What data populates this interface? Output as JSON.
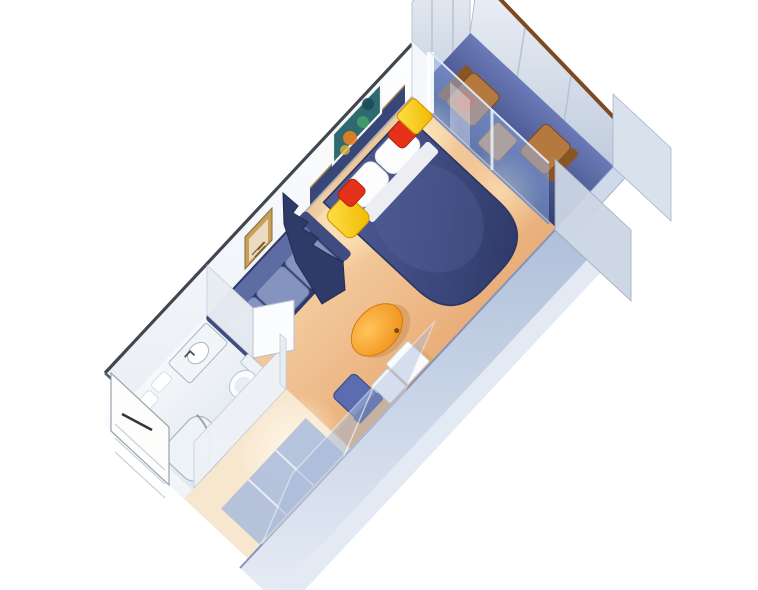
{
  "scene": {
    "name": "balcony-stateroom-isometric-floorplan",
    "rooms": [
      "entry",
      "bathroom",
      "wardrobe",
      "living-area",
      "sleeping-area",
      "balcony"
    ],
    "furniture": [
      "queen-bed",
      "pillow-left",
      "pillow-right",
      "bed-sheet-fold",
      "nightstand-left",
      "nightstand-right",
      "red-cushion-left",
      "red-cushion-right",
      "zigzag-room-divider",
      "sofa",
      "coffee-table",
      "vanity-desk",
      "desk-chair",
      "tv-cabinet",
      "dresser-box",
      "wardrobe-doors",
      "shower",
      "toilet",
      "sink-counter",
      "entry-door",
      "bathroom-door",
      "balcony-glass-door",
      "balcony-chair-upper",
      "balcony-chair-lower",
      "balcony-table",
      "reef-artwork",
      "gold-artwork",
      "balcony-railing",
      "neighbor-balcony-divider"
    ]
  },
  "palette": {
    "background": "#ffffff",
    "carpet_light": "#f8d7ae",
    "carpet_dark": "#e9ae79",
    "carpet_glow": "#ffeac0",
    "corridor_floor": "#f7e7cf",
    "bathroom_floor_light": "#f6f8fa",
    "bathroom_floor_dark": "#dfe7ef",
    "deck_dark": "#333f72",
    "deck_light": "#6b7ab8",
    "wall_face_light": "#ffffff",
    "wall_face_dark": "#e9eef5",
    "panel_light": "#f4f7fa",
    "panel_dark": "#c4cfdf",
    "wall_cap": "#42464f",
    "brown_cap": "#7b4a22",
    "outer_wall_light": "#e6ecf5",
    "outer_wall_dark": "#b0c0da",
    "glass_blue": "#8fb0e8",
    "bed_light": "#4d5a94",
    "bed_dark": "#2e3968",
    "bed_edge": "#2a3560",
    "headboard_navy": "#394778",
    "pillow_white": "#fdfdfd",
    "sofa_frame": "#2d3a6a",
    "sofa_cushion": "#8593bf",
    "sofa_back": "#5d6ca2",
    "accent_red": "#e63119",
    "accent_yellow_light": "#ffe14a",
    "accent_yellow_dark": "#f0b800",
    "accent_orange_light": "#ffc45c",
    "accent_orange_dark": "#ef8c12",
    "wood_tan": "#e2a96b",
    "balcony_wood": "#b5793f",
    "balcony_wood_dark": "#8a5524",
    "artwork_teal": "#2e6a70",
    "artwork_gold": "#c8a05c",
    "closet_glass": "#a9bbdc",
    "fixture_white": "#f2f5f8",
    "fixture_stroke": "#aab6c4",
    "divider_navy": "#2e3a68"
  }
}
